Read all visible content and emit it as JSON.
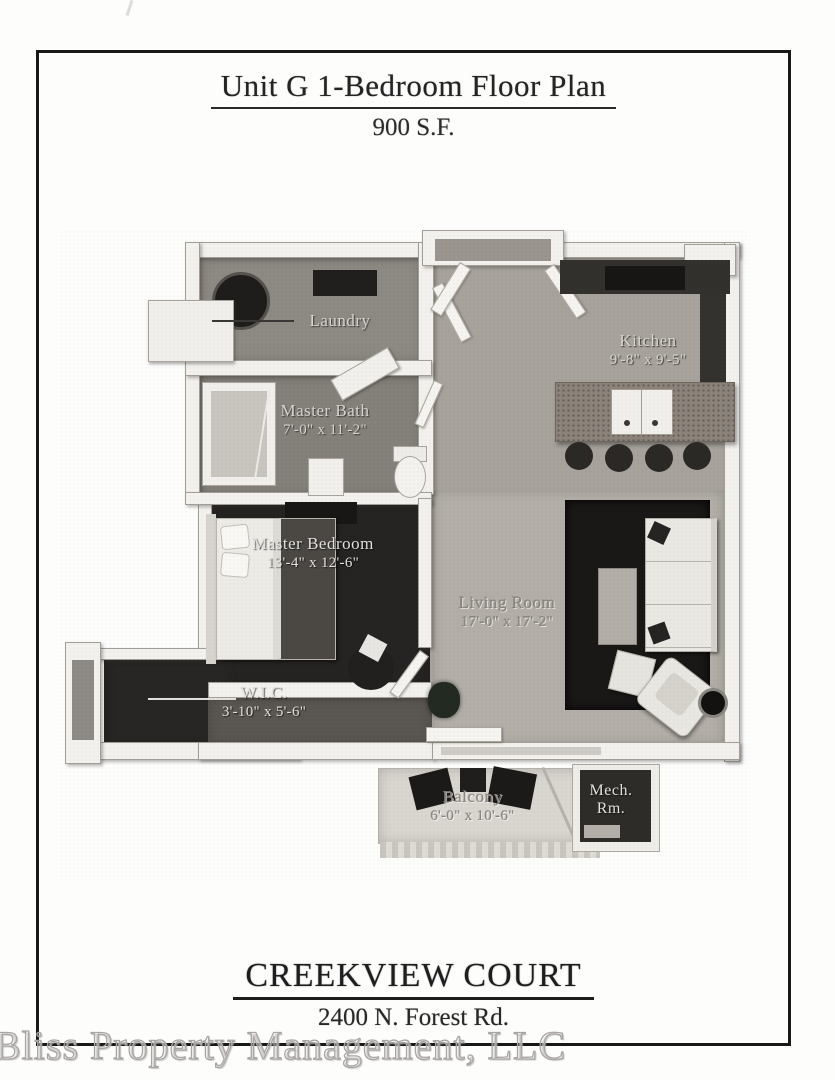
{
  "header": {
    "title": "Unit G 1-Bedroom Floor Plan",
    "subtitle": "900 S.F."
  },
  "footer": {
    "property_name": "CREEKVIEW COURT",
    "address": "2400 N. Forest Rd."
  },
  "watermark": "Bliss Property Management, LLC",
  "floor_plan": {
    "rooms": [
      {
        "id": "laundry",
        "name": "Laundry",
        "dimensions": ""
      },
      {
        "id": "kitchen",
        "name": "Kitchen",
        "dimensions": "9'-8\" x 9'-5\""
      },
      {
        "id": "master-bath",
        "name": "Master Bath",
        "dimensions": "7'-0\" x 11'-2\""
      },
      {
        "id": "master-bedroom",
        "name": "Master Bedroom",
        "dimensions": "13'-4\" x 12'-6\""
      },
      {
        "id": "living-room",
        "name": "Living Room",
        "dimensions": "17'-0\" x 17'-2\""
      },
      {
        "id": "wic",
        "name": "W.I.C.",
        "dimensions": "3'-10\" x 5'-6\""
      },
      {
        "id": "balcony",
        "name": "Balcony",
        "dimensions": "6'-0\" x 10'-6\""
      },
      {
        "id": "mech-room",
        "name": "Mech. Rm.",
        "dimensions": ""
      }
    ]
  }
}
